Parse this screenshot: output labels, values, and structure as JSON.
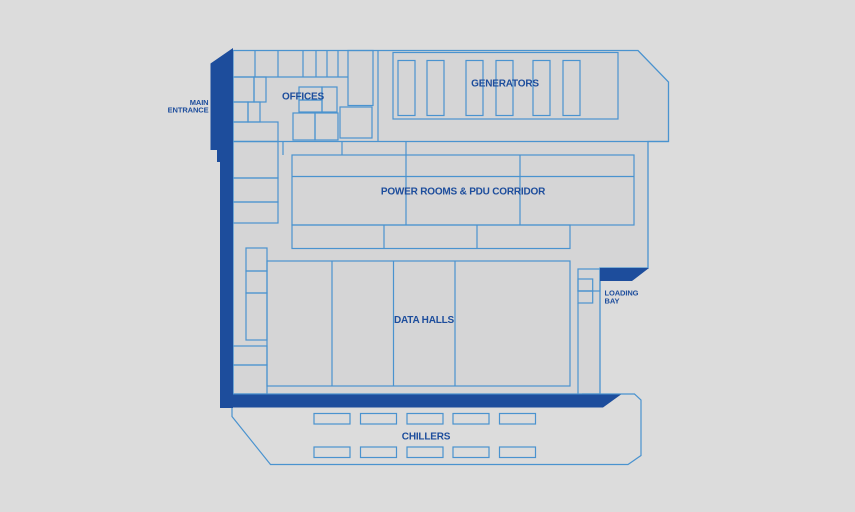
{
  "floor_plan": {
    "areas": {
      "main_entrance": {
        "label_line1": "MAIN",
        "label_line2": "ENTRANCE"
      },
      "offices": {
        "label": "OFFICES"
      },
      "generators": {
        "label": "GENERATORS",
        "generator_slot_count": 6
      },
      "power_rooms": {
        "label": "POWER ROOMS & PDU CORRIDOR"
      },
      "data_halls": {
        "label": "DATA HALLS",
        "hall_count": 4
      },
      "loading_bay": {
        "label_line1": "LOADING",
        "label_line2": "BAY"
      },
      "chillers": {
        "label": "CHILLERS",
        "unit_rows": 2,
        "units_per_row": 5,
        "unit_count": 10
      }
    },
    "colors": {
      "background": "#dcdcdc",
      "building_fill": "#d5d5d6",
      "line_blue": "#4a93cf",
      "accent_navy": "#1d4d9c"
    }
  }
}
